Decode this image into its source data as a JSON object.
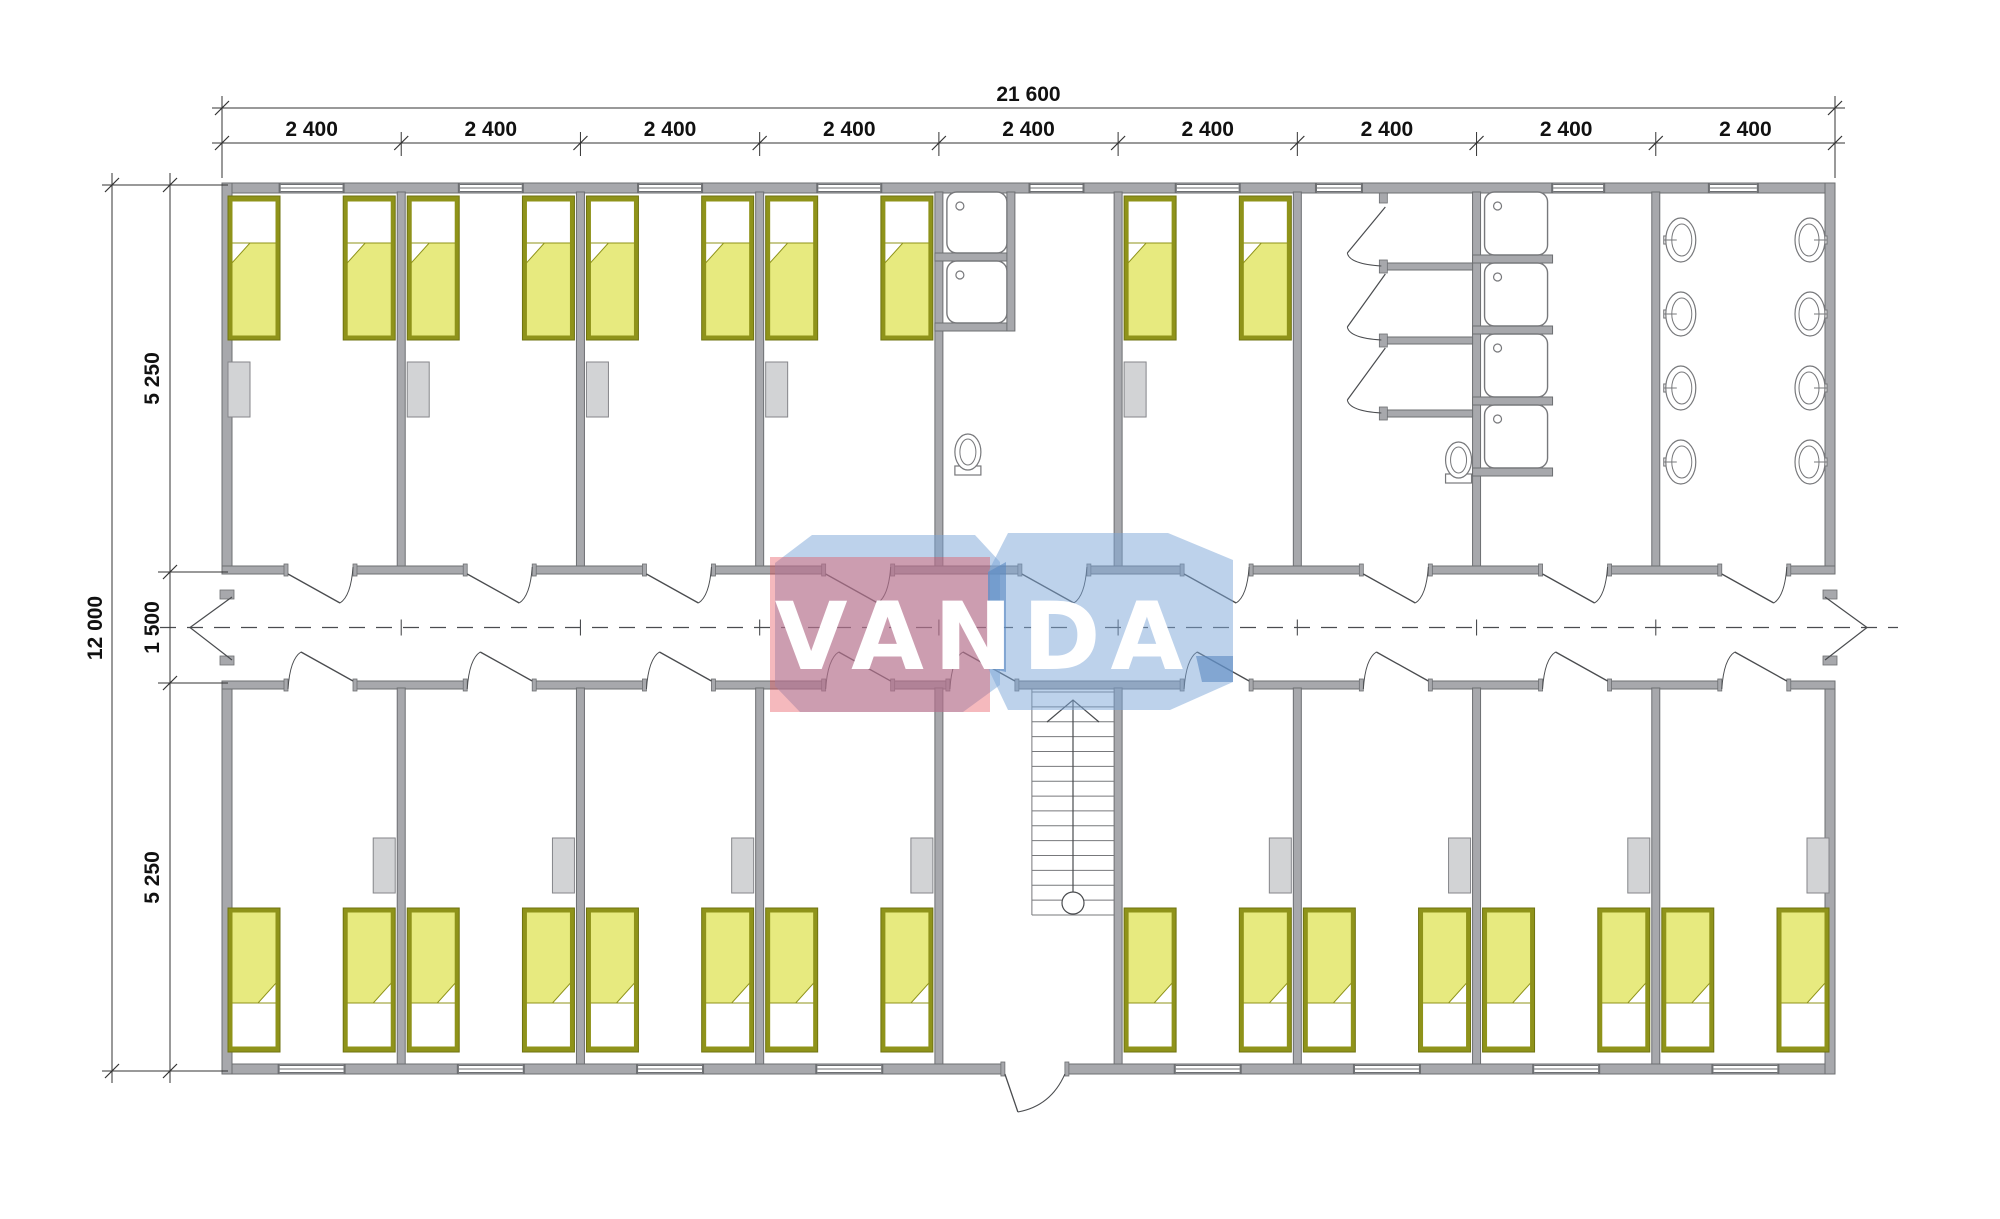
{
  "title": "Modular dormitory floor plan",
  "watermark": {
    "text": "VANDA",
    "red_block_color": "rgba(230,72,82,0.38)",
    "blue_block_color": "rgba(124,166,215,0.50)",
    "blue_edge_color": "rgba(90,137,194,0.60)",
    "text_color": "#ffffff"
  },
  "dimensions": {
    "top": {
      "total": "21 600",
      "segments": [
        "2 400",
        "2 400",
        "2 400",
        "2 400",
        "2 400",
        "2 400",
        "2 400",
        "2 400",
        "2 400"
      ]
    },
    "left": {
      "total": "12 000",
      "segments": [
        "5 250",
        "1 500",
        "5 250"
      ]
    }
  },
  "plan": {
    "modules": [
      {
        "id": 1,
        "top": "bedroom",
        "bottom": "bedroom"
      },
      {
        "id": 2,
        "top": "bedroom",
        "bottom": "bedroom"
      },
      {
        "id": 3,
        "top": "bedroom",
        "bottom": "bedroom"
      },
      {
        "id": 4,
        "top": "bedroom",
        "bottom": "bedroom"
      },
      {
        "id": 5,
        "top": "washroom",
        "bottom": "stairs-entry"
      },
      {
        "id": 6,
        "top": "bedroom",
        "bottom": "bedroom"
      },
      {
        "id": 7,
        "top": "wc-stalls",
        "bottom": "bedroom"
      },
      {
        "id": 8,
        "top": "showers",
        "bottom": "bedroom"
      },
      {
        "id": 9,
        "top": "washbasins",
        "bottom": "bedroom"
      }
    ],
    "fixtures": {
      "beds_per_bedroom": 2,
      "washroom_shower_trays": 2,
      "washroom_toilets": 1,
      "shower_room_trays": 4,
      "wc_stall_count": 3,
      "wc_toilets": 1,
      "washbasins_per_wall": 4,
      "stair_tread_count": 15
    },
    "colors": {
      "wall_fill": "#a7a8ac",
      "wall_edge": "#6d6f72",
      "bed_frame": "#8f931a",
      "bed_blanket": "#e7ea7f",
      "pillow": "#ffffff",
      "cabinet_fill": "#d2d3d5",
      "cabinet_edge": "#85868a",
      "fixture_stroke": "#77787b",
      "thin_line": "#4a4c4f",
      "dimension_line": "#333333"
    }
  }
}
